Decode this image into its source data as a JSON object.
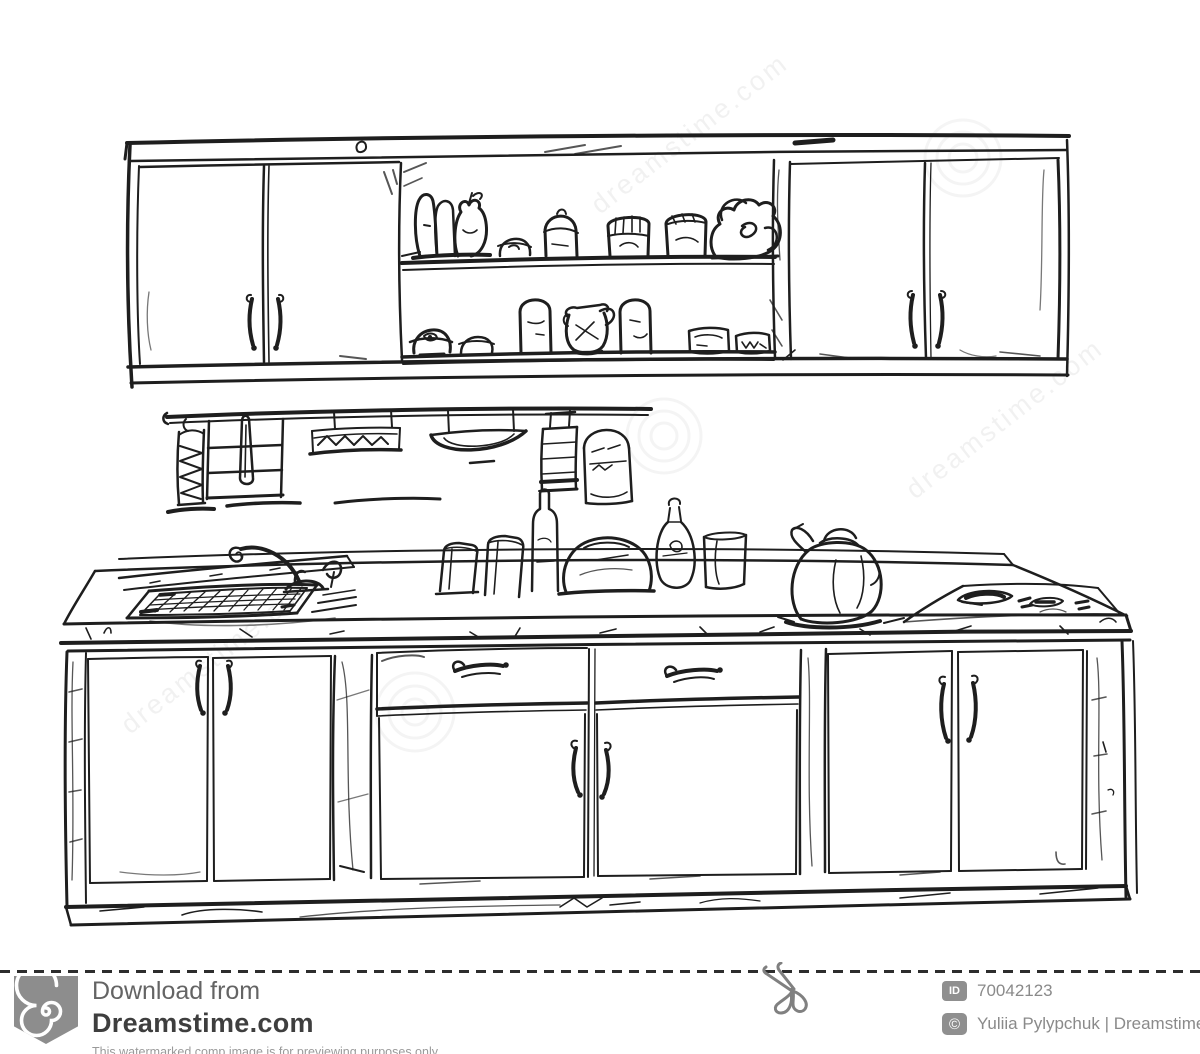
{
  "image": {
    "kind": "hand-drawn kitchen furniture sketch",
    "elements": [
      "upper-cabinets",
      "open-shelves-with-dishes",
      "wall-rail-with-towels-and-utensils",
      "countertop-with-sink-and-faucet",
      "kettle",
      "cooktop",
      "base-cabinets-with-drawers"
    ]
  },
  "watermark": {
    "tile_text": "dreamstime.com"
  },
  "footer": {
    "download_label": "Download from",
    "brand": "Dreamstime.com",
    "disclaimer": "This watermarked comp image is for previewing purposes only.",
    "id_label": "ID",
    "image_id": "70042123",
    "credit": "Yuliia Pylypchuk | Dreamstime.com"
  },
  "icons": {
    "scissors": "scissors-cut-mark",
    "copyright": "©",
    "logo": "dreamstime-spiral"
  },
  "colors": {
    "ink": "#1e1e1e",
    "paper": "#ffffff",
    "watermark_gray": "#8d8d8d",
    "footer_label": "#646464",
    "brand_text": "#3e3e3e",
    "meta_text": "#8a8a8a"
  }
}
